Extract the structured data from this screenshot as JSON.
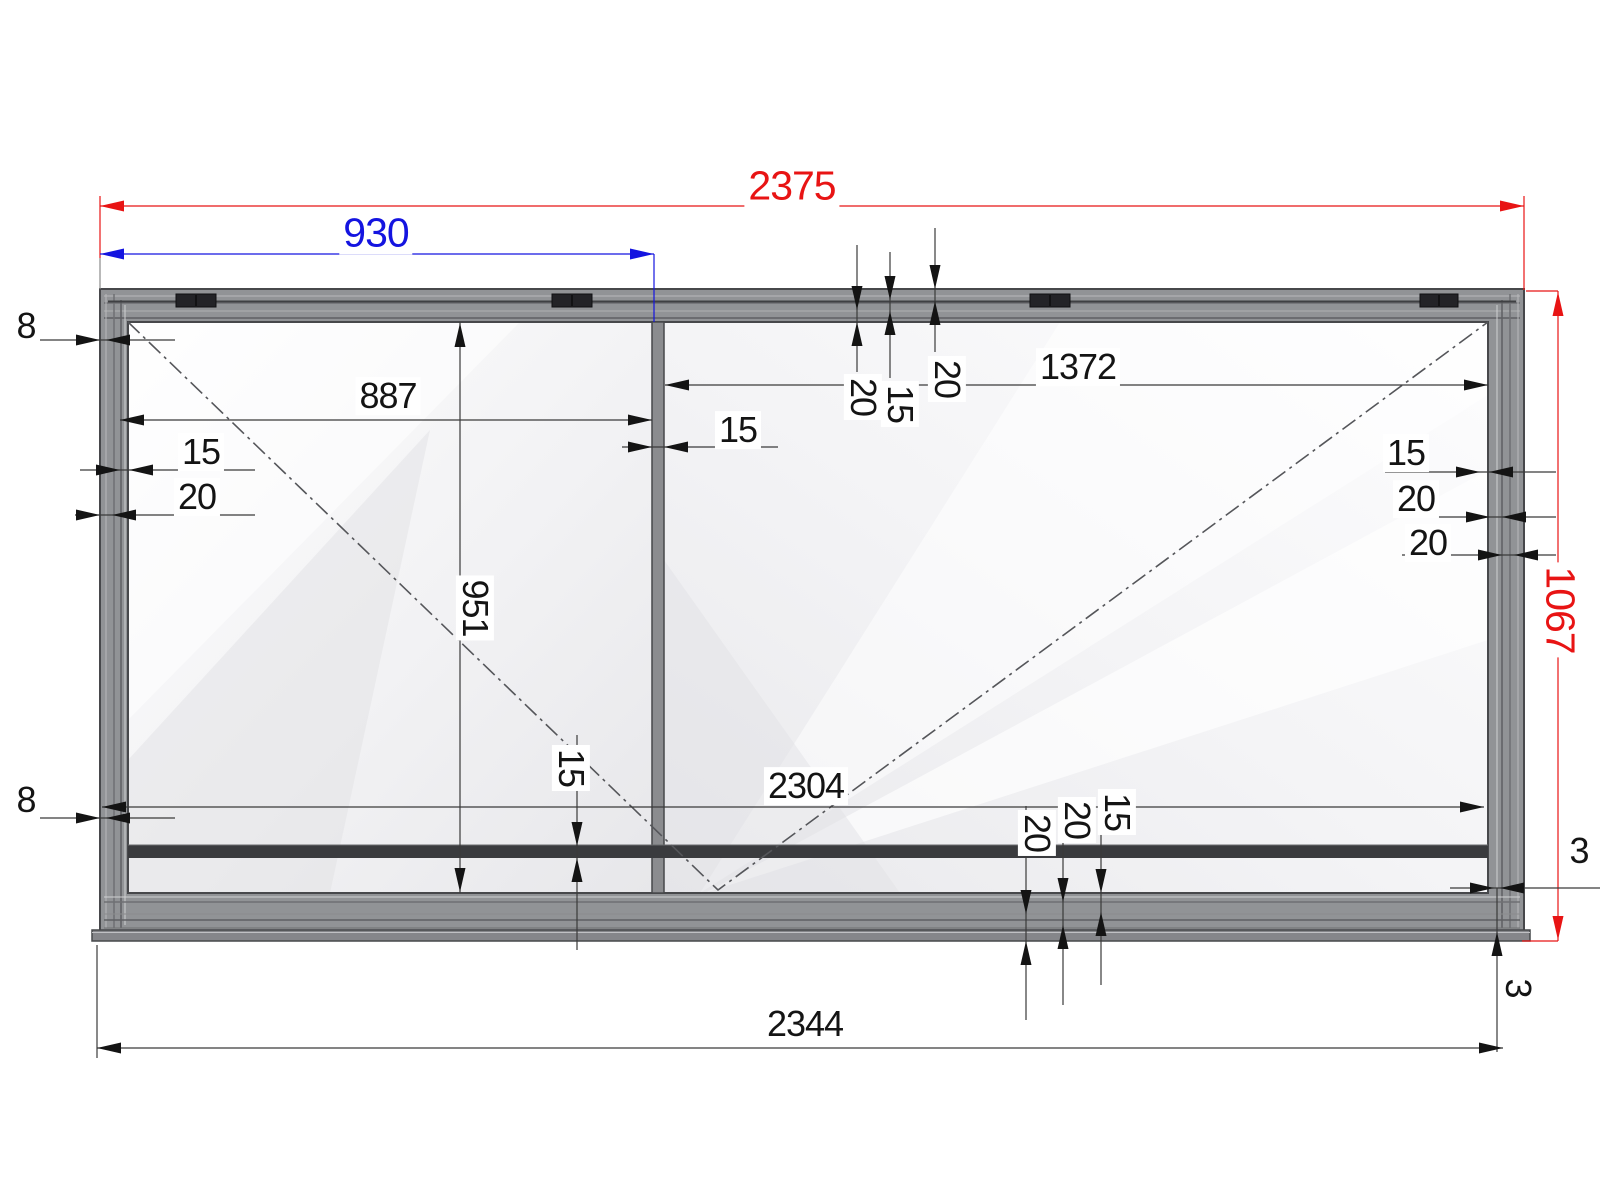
{
  "drawing": {
    "kind": "sliding-window-frame-dimension-drawing"
  },
  "colors": {
    "dimension_red": "#e81414",
    "dimension_blue": "#1414e0",
    "dimension_black": "#141414",
    "frame_gray": "#919396",
    "dark_bar": "#3a3b3e"
  },
  "dims": {
    "overall_width": "2375",
    "sash_width": "930",
    "left_glass_width": "887",
    "right_glass_width": "1372",
    "overall_height": "1067",
    "glass_height": "951",
    "clear_width": "2304",
    "base_width": "2344",
    "reveal_top_left": "8",
    "reveal_bottom_left": "8",
    "left_glazing": "15",
    "left_frame": "20",
    "mullion": "15",
    "top_profile_a": "20",
    "top_profile_b": "15",
    "top_profile_c": "20",
    "right_glazing": "15",
    "right_frame_a": "20",
    "right_frame_b": "20",
    "bottom_bar": "15",
    "bottom_profile_a": "20",
    "bottom_profile_b": "20",
    "bottom_profile_c": "15",
    "gap_right": "3",
    "gap_bottom_right": "3"
  }
}
